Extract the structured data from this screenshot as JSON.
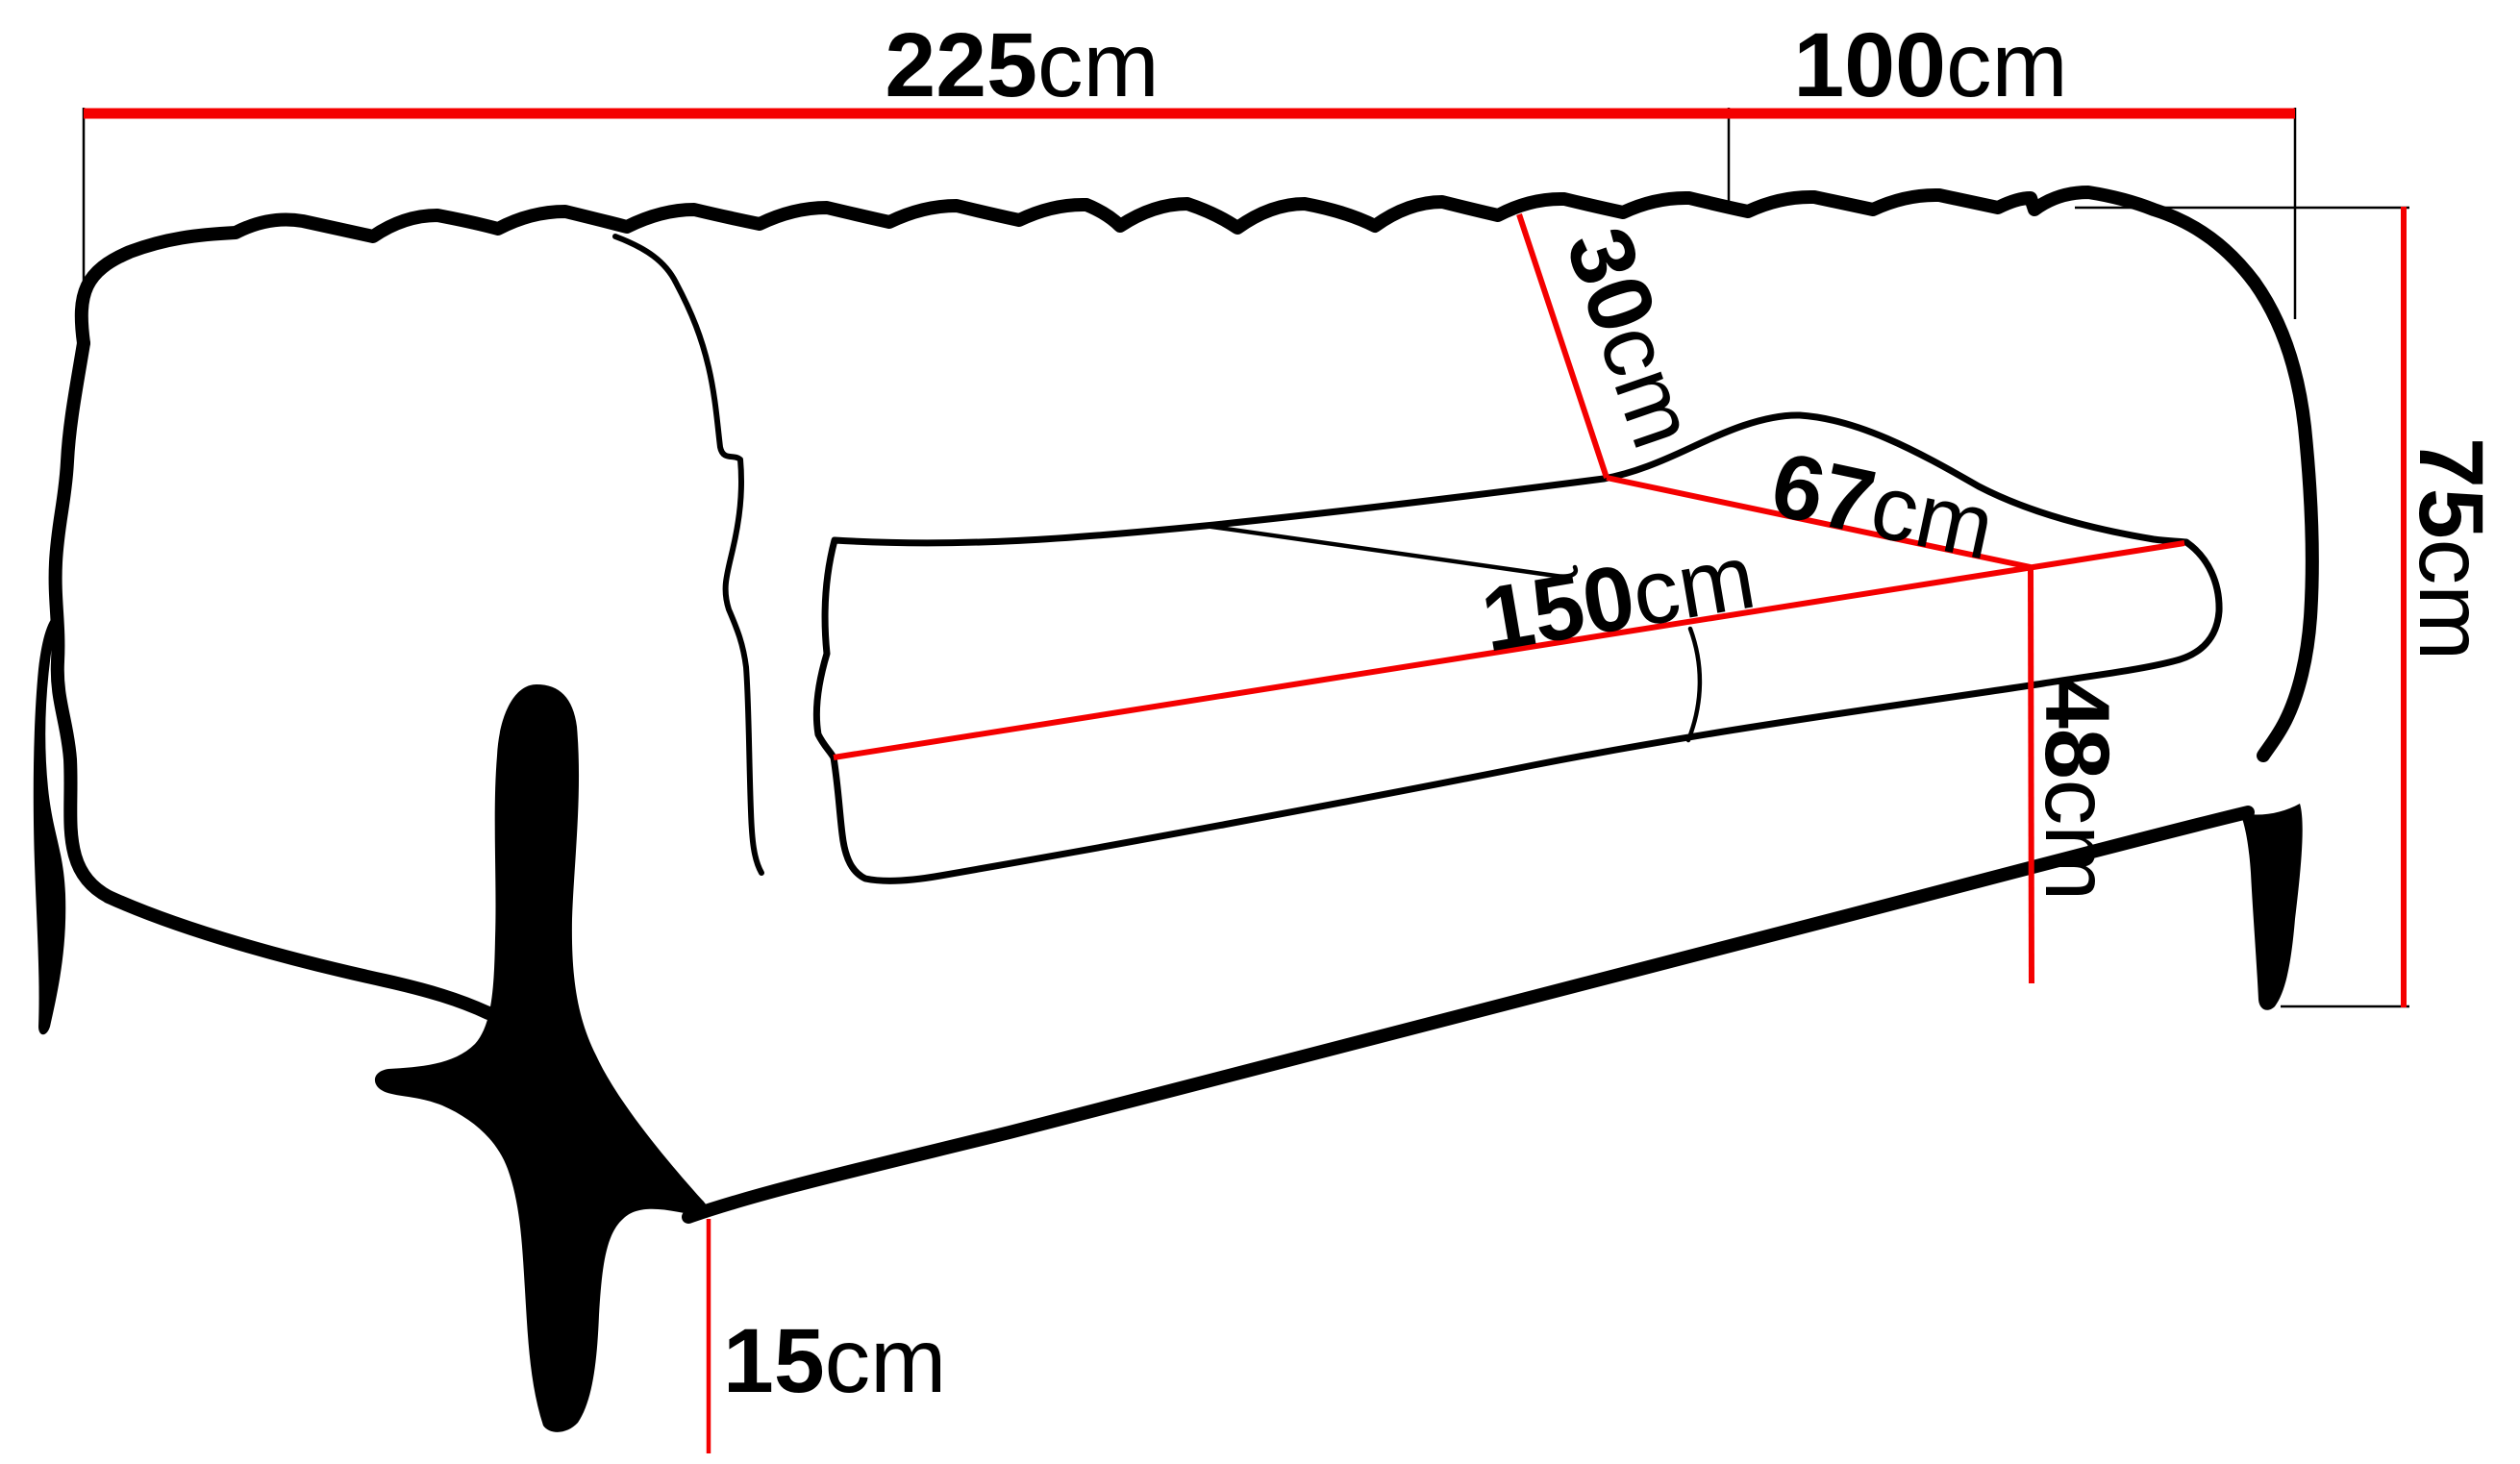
{
  "title": "Sofa dimensions technical diagram",
  "colors": {
    "line": "#000000",
    "dimension": "#f40000",
    "background": "#ffffff"
  },
  "dimensions": {
    "overall_width": {
      "value": "225",
      "unit": "cm"
    },
    "overall_depth": {
      "value": "100",
      "unit": "cm"
    },
    "overall_height": {
      "value": "75",
      "unit": "cm"
    },
    "backrest_height": {
      "value": "30",
      "unit": "cm"
    },
    "seat_depth": {
      "value": "67",
      "unit": "cm"
    },
    "seat_width": {
      "value": "150",
      "unit": "cm"
    },
    "seat_height": {
      "value": "48",
      "unit": "cm"
    },
    "leg_height": {
      "value": "15",
      "unit": "cm"
    }
  }
}
